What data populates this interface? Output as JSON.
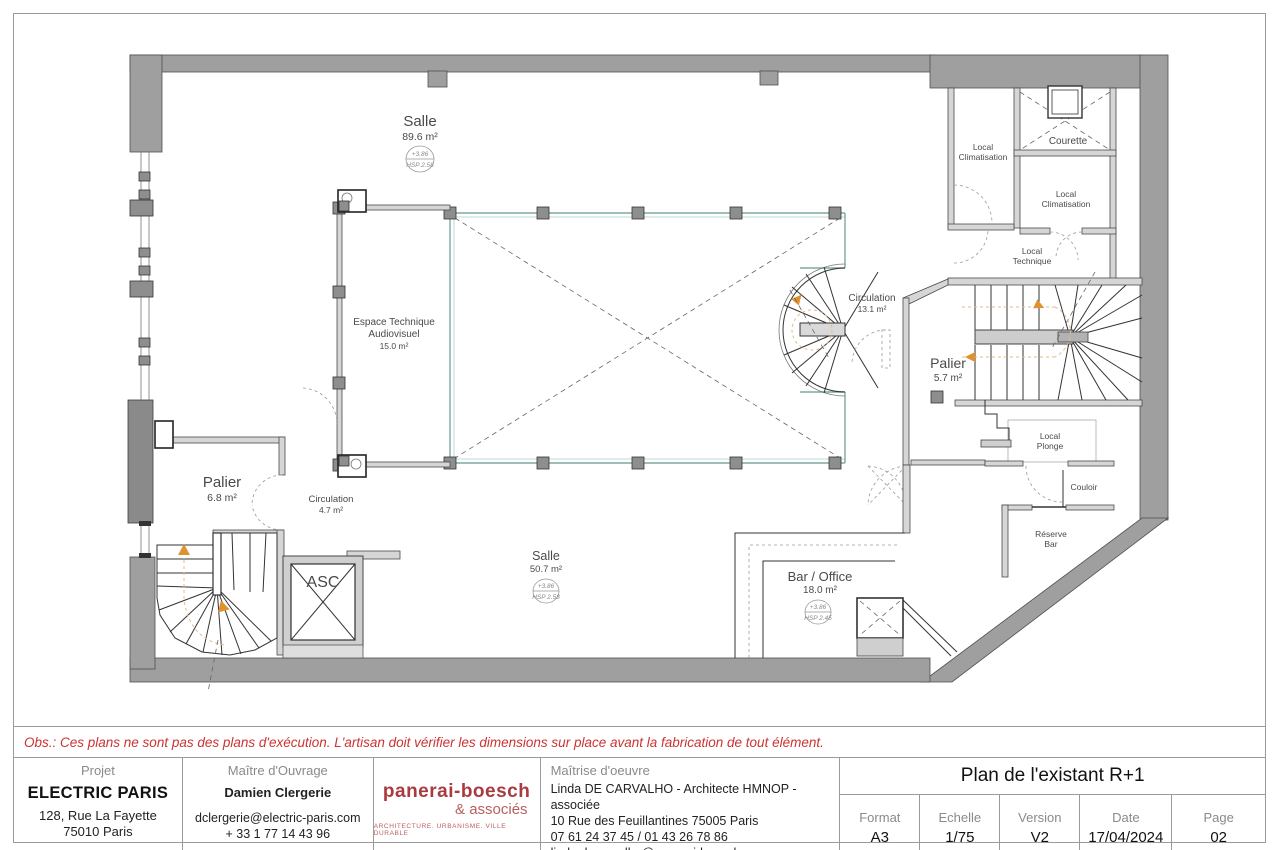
{
  "note": "Obs.: Ces plans ne sont pas des plans d'exécution. L'artisan doit vérifier les dimensions sur place avant la fabrication de tout élément.",
  "plan": {
    "rooms": {
      "salle1": {
        "name": "Salle",
        "area": "89.6 m²",
        "level": "+3.86",
        "hsp": "HSP 2.58"
      },
      "espace_technique": {
        "line1": "Espace Technique",
        "line2": "Audiovisuel",
        "area": "15.0 m²"
      },
      "circulation1": {
        "name": "Circulation",
        "area": "13.1 m²"
      },
      "palier1": {
        "name": "Palier",
        "area": "5.7 m²"
      },
      "local_clim_1": {
        "line1": "Local",
        "line2": "Climatisation"
      },
      "courette": {
        "name": "Courette"
      },
      "local_clim_2": {
        "line1": "Local",
        "line2": "Climatisation"
      },
      "local_technique": {
        "line1": "Local",
        "line2": "Technique"
      },
      "local_plonge": {
        "line1": "Local",
        "line2": "Plonge"
      },
      "couloir": {
        "name": "Couloir"
      },
      "reserve_bar": {
        "line1": "Réserve",
        "line2": "Bar"
      },
      "palier2": {
        "name": "Palier",
        "area": "6.8 m²"
      },
      "circulation2": {
        "name": "Circulation",
        "area": "4.7 m²"
      },
      "ascenseur": {
        "name": "ASC"
      },
      "salle2": {
        "name": "Salle",
        "area": "50.7 m²",
        "level": "+3.86",
        "hsp": "HSP 2.58"
      },
      "bar_office": {
        "name": "Bar / Office",
        "area": "18.0 m²",
        "level": "+3.86",
        "hsp": "HSP 2.45"
      }
    }
  },
  "title_block": {
    "projet": {
      "label": "Projet",
      "name": "ELECTRIC PARIS",
      "address_line1": "128, Rue La Fayette",
      "address_line2": "75010 Paris"
    },
    "maitre_douvrage": {
      "label": "Maître d'Ouvrage",
      "name": "Damien Clergerie",
      "email": "dclergerie@electric-paris.com",
      "phone": "+ 33 1 77 14 43 96"
    },
    "logo": {
      "line1": "panerai-boesch",
      "line2": "& associés",
      "tagline": "ARCHITECTURE. URBANISME. VILLE DURABLE"
    },
    "maitrise_doeuvre": {
      "label": "Maîtrise d'oeuvre",
      "line1": "Linda DE CARVALHO - Architecte HMNOP - associée",
      "line2": "10 Rue des Feuillantines 75005 Paris",
      "line3": "07 61 24 37 45 / 01 43 26 78 86",
      "line4": "linda.decarvalho@panerai-boesch.com"
    },
    "drawing_title": "Plan de l'existant R+1",
    "meta": [
      {
        "label": "Format",
        "value": "A3"
      },
      {
        "label": "Echelle",
        "value": "1/75"
      },
      {
        "label": "Version",
        "value": "V2"
      },
      {
        "label": "Date",
        "value": "17/04/2024"
      },
      {
        "label": "Page",
        "value": "02"
      }
    ]
  },
  "colors": {
    "accent_red": "#cc3333",
    "logo_red": "#a93b3f",
    "wall_gray": "#9f9f9f",
    "rail_teal": "#7fa8a4",
    "arrow_orange": "#e0922f"
  }
}
